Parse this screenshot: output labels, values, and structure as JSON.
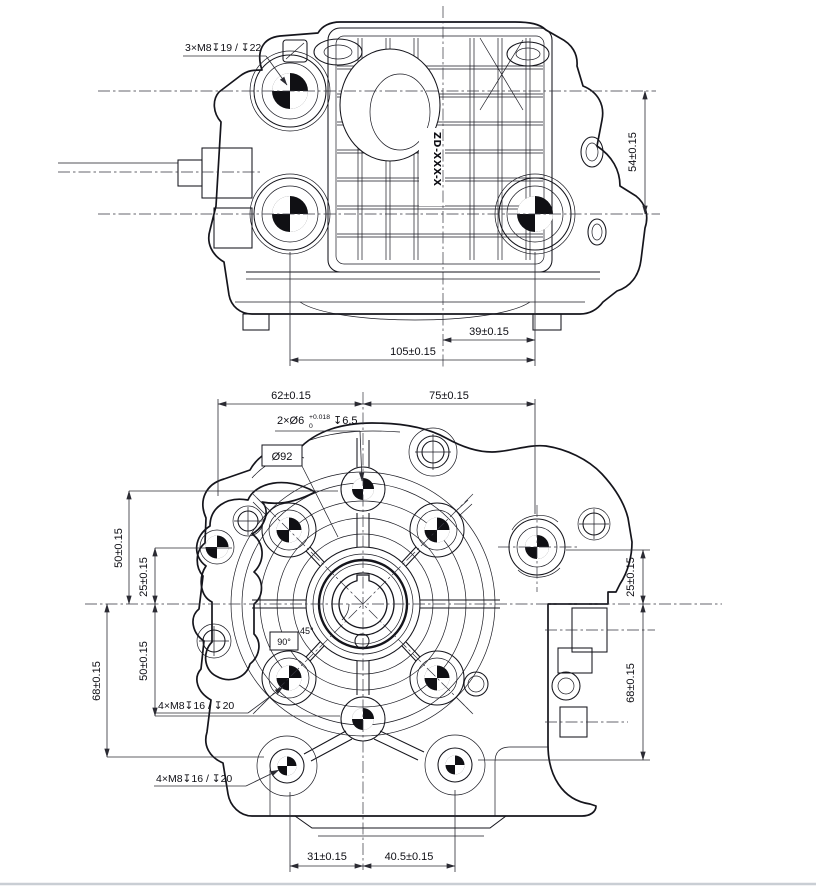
{
  "page": {
    "background": "#ffffff"
  },
  "colors": {
    "line": "#15151c",
    "dimension": "#2b2b33",
    "centerline": "#34343e",
    "page_rule": "#c9ced4"
  },
  "top_view": {
    "part_label": "ZD-XXX-X",
    "callout_cover_bolts": "3×M8↧19 / ↧22",
    "dim_boss_spacing_vertical": "54±0.15",
    "dim_boss_to_center": "39±0.15",
    "dim_boss_spacing_horizontal": "105±0.15"
  },
  "front_view": {
    "callout_dowel": {
      "prefix": "2×Ø6",
      "tol_upper": "+0.018",
      "tol_lower": "0",
      "depth": "↧6.5"
    },
    "label_bolt_circle": "Ø92",
    "angle_quarter": "90°",
    "angle_eighth": "45°",
    "callout_flange_bolts_mid": "4×M8↧16 / ↧20",
    "callout_flange_bolts_bottom": "4×M8↧16 / ↧20",
    "dim_top_left": "62±0.15",
    "dim_top_right": "75±0.15",
    "dim_left_upper": "50±0.15",
    "dim_left_inner": "25±0.15",
    "dim_left_outer": "68±0.15",
    "dim_left_lower": "50±0.15",
    "dim_right_upper": "25±0.15",
    "dim_right_lower": "68±0.15",
    "dim_bottom_left": "31±0.15",
    "dim_bottom_right": "40.5±0.15"
  }
}
